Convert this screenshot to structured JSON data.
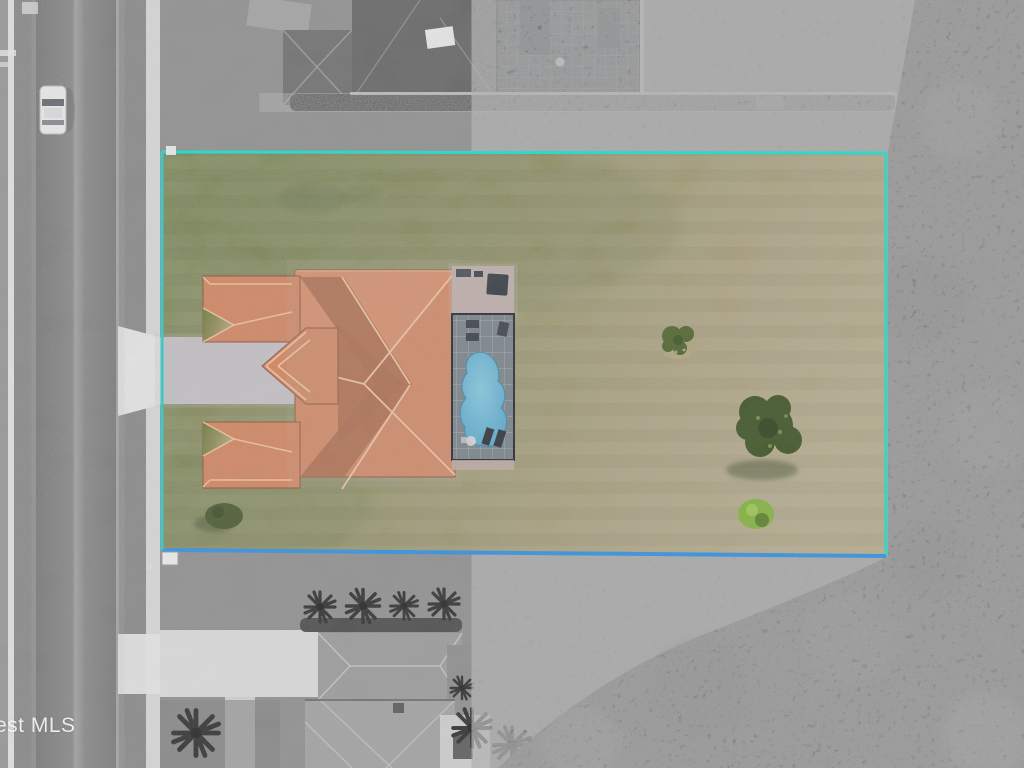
{
  "watermark": {
    "text": "est MLS"
  },
  "colors": {
    "base_gray": "#8f8f8f",
    "road_asphalt": "#747474",
    "road_seam": "#9e9e9e",
    "road_edge": "#aaaaaa",
    "verge": "#888888",
    "sidewalk": "#d8d8d8",
    "curb_white": "#e2e2e2",
    "apron": "#e6e6e6",
    "vehicle_body": "#f4f4f4",
    "vehicle_glass": "#555b63",
    "top_roof": "#646464",
    "top_roof_hip": "#6e6e6e",
    "top_ridge": "#9b9b9b",
    "ac_white": "#e9e9e9",
    "cage_gray": "#43474b",
    "cage_grid": "#75797e",
    "cage_dark": "#2e3236",
    "hedge": "#3c3c3c",
    "hedge_rail": "#c4c4c4",
    "canopy": "#4a4a4a",
    "canopy_dark": "#353535",
    "canopy_light": "#6b6b6b",
    "grass_a": "#6e7c3e",
    "grass_b": "#8d8a55",
    "grass_c": "#a89b70",
    "grass_d": "#b4a77e",
    "grass_dark": "#55662f",
    "boundary_top": "#12e0d0",
    "boundary_right": "#19dccd",
    "boundary_left": "#2cc9c6",
    "boundary_bottom": "#2e8fe0",
    "marker_white": "#efefef",
    "roof_main": "#d2845f",
    "roof_light": "#dc926d",
    "roof_dark": "#ab6647",
    "roof_ridge": "#f2c79e",
    "roof_eave": "#8a4f36",
    "paver_drive": "#c7c2c8",
    "patio_paver": "#bfaaa6",
    "deck": "#79828a",
    "screen_frame": "#23272b",
    "screen_grid": "#b3bac0",
    "pool": "#4fa0c8",
    "pool_light": "#83c9e0",
    "furniture_dark": "#2a2f34",
    "table_white": "#dadada",
    "tree_dark": "#3a5020",
    "tree_mid": "#4c6229",
    "tree_speck": "#6f8c3f",
    "shrub": "#82b13d",
    "shadow_green": "#2c3a1b",
    "bot_roof": "#9b9b9b",
    "bot_roof2": "#a2a2a2",
    "bot_ridge": "#c6c6c6",
    "bot_wing": "#8d8d8d",
    "palm": "#2d2d2d",
    "bot_drive": "#dcdcdc",
    "bush_gray": "#4a4a4a",
    "patio_white": "#cfcfcf"
  }
}
